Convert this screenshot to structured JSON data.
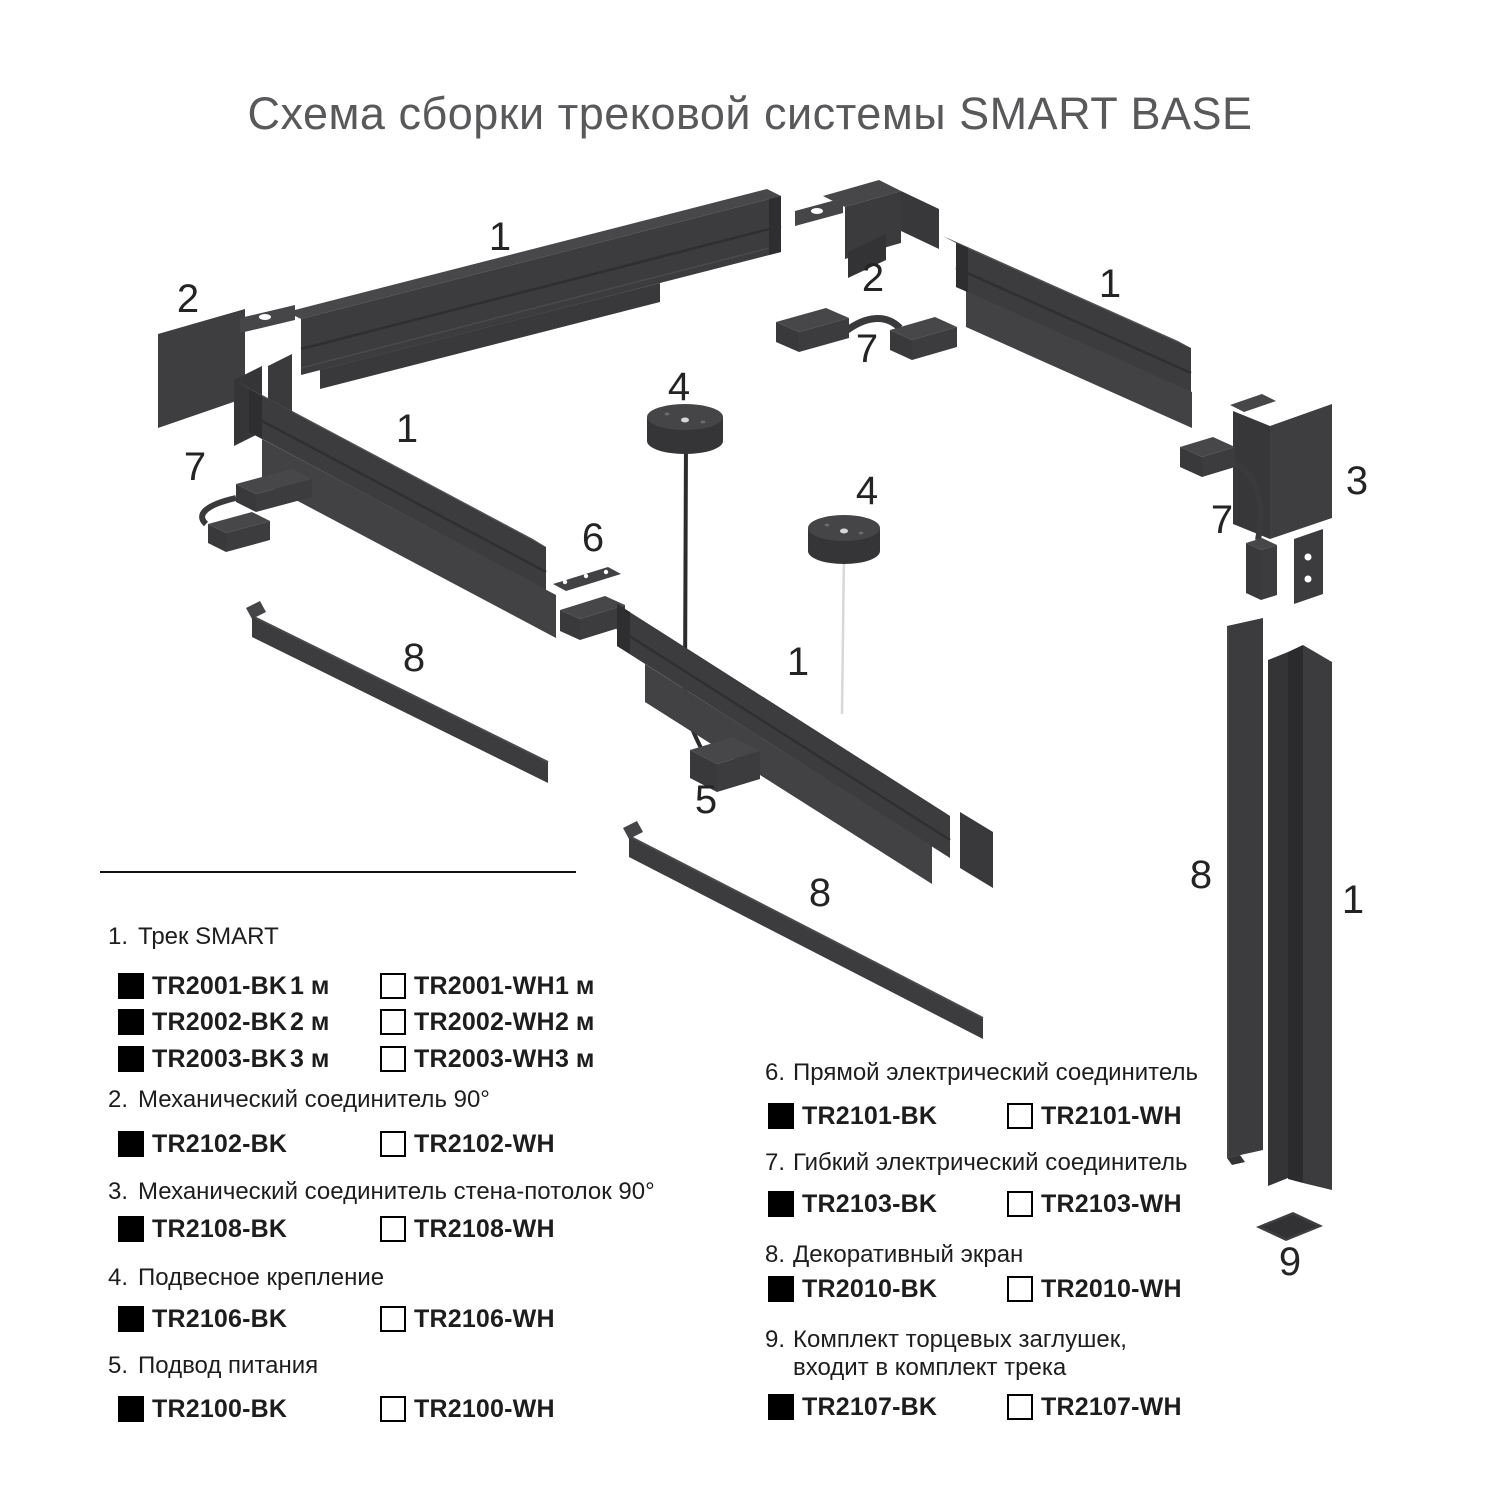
{
  "title": "Схема сборки трековой системы SMART BASE",
  "colors": {
    "part_main": "#3c3c3e",
    "part_dark": "#2e2e30",
    "part_light": "#47474a",
    "title_text": "#59595b",
    "legend_text": "#1d1d1d",
    "swatch_black": "#000000",
    "swatch_white": "#ffffff",
    "white_cord": "#d8d8d8"
  },
  "diagram": {
    "callouts": [
      "1",
      "2",
      "2",
      "7",
      "1",
      "1",
      "7",
      "4",
      "4",
      "6",
      "3",
      "7",
      "8",
      "1",
      "5",
      "8",
      "8",
      "1",
      "9"
    ]
  },
  "legend": {
    "sections": [
      {
        "num": "1.",
        "title": "Трек SMART",
        "rows": [
          {
            "bk": "TR2001-BK",
            "bk_size": "1 м",
            "wh": "TR2001-WH",
            "wh_size": "1 м"
          },
          {
            "bk": "TR2002-BK",
            "bk_size": "2 м",
            "wh": "TR2002-WH",
            "wh_size": "2 м"
          },
          {
            "bk": "TR2003-BK",
            "bk_size": "3 м",
            "wh": "TR2003-WH",
            "wh_size": "3 м"
          }
        ]
      },
      {
        "num": "2.",
        "title": "Механический соединитель 90°",
        "rows": [
          {
            "bk": "TR2102-BK",
            "wh": "TR2102-WH"
          }
        ]
      },
      {
        "num": "3.",
        "title": "Механический соединитель стена-потолок 90°",
        "rows": [
          {
            "bk": "TR2108-BK",
            "wh": "TR2108-WH"
          }
        ]
      },
      {
        "num": "4.",
        "title": "Подвесное крепление",
        "rows": [
          {
            "bk": "TR2106-BK",
            "wh": "TR2106-WH"
          }
        ]
      },
      {
        "num": "5.",
        "title": "Подвод питания",
        "rows": [
          {
            "bk": "TR2100-BK",
            "wh": "TR2100-WH"
          }
        ]
      },
      {
        "num": "6.",
        "title": "Прямой электрический соединитель",
        "rows": [
          {
            "bk": "TR2101-BK",
            "wh": "TR2101-WH"
          }
        ]
      },
      {
        "num": "7.",
        "title": "Гибкий электрический соединитель",
        "rows": [
          {
            "bk": "TR2103-BK",
            "wh": "TR2103-WH"
          }
        ]
      },
      {
        "num": "8.",
        "title": "Декоративный экран",
        "rows": [
          {
            "bk": "TR2010-BK",
            "wh": "TR2010-WH"
          }
        ]
      },
      {
        "num": "9.",
        "title": "Комплект торцевых заглушек,",
        "title_line2": "входит в комплект трека",
        "rows": [
          {
            "bk": "TR2107-BK",
            "wh": "TR2107-WH"
          }
        ]
      }
    ]
  }
}
